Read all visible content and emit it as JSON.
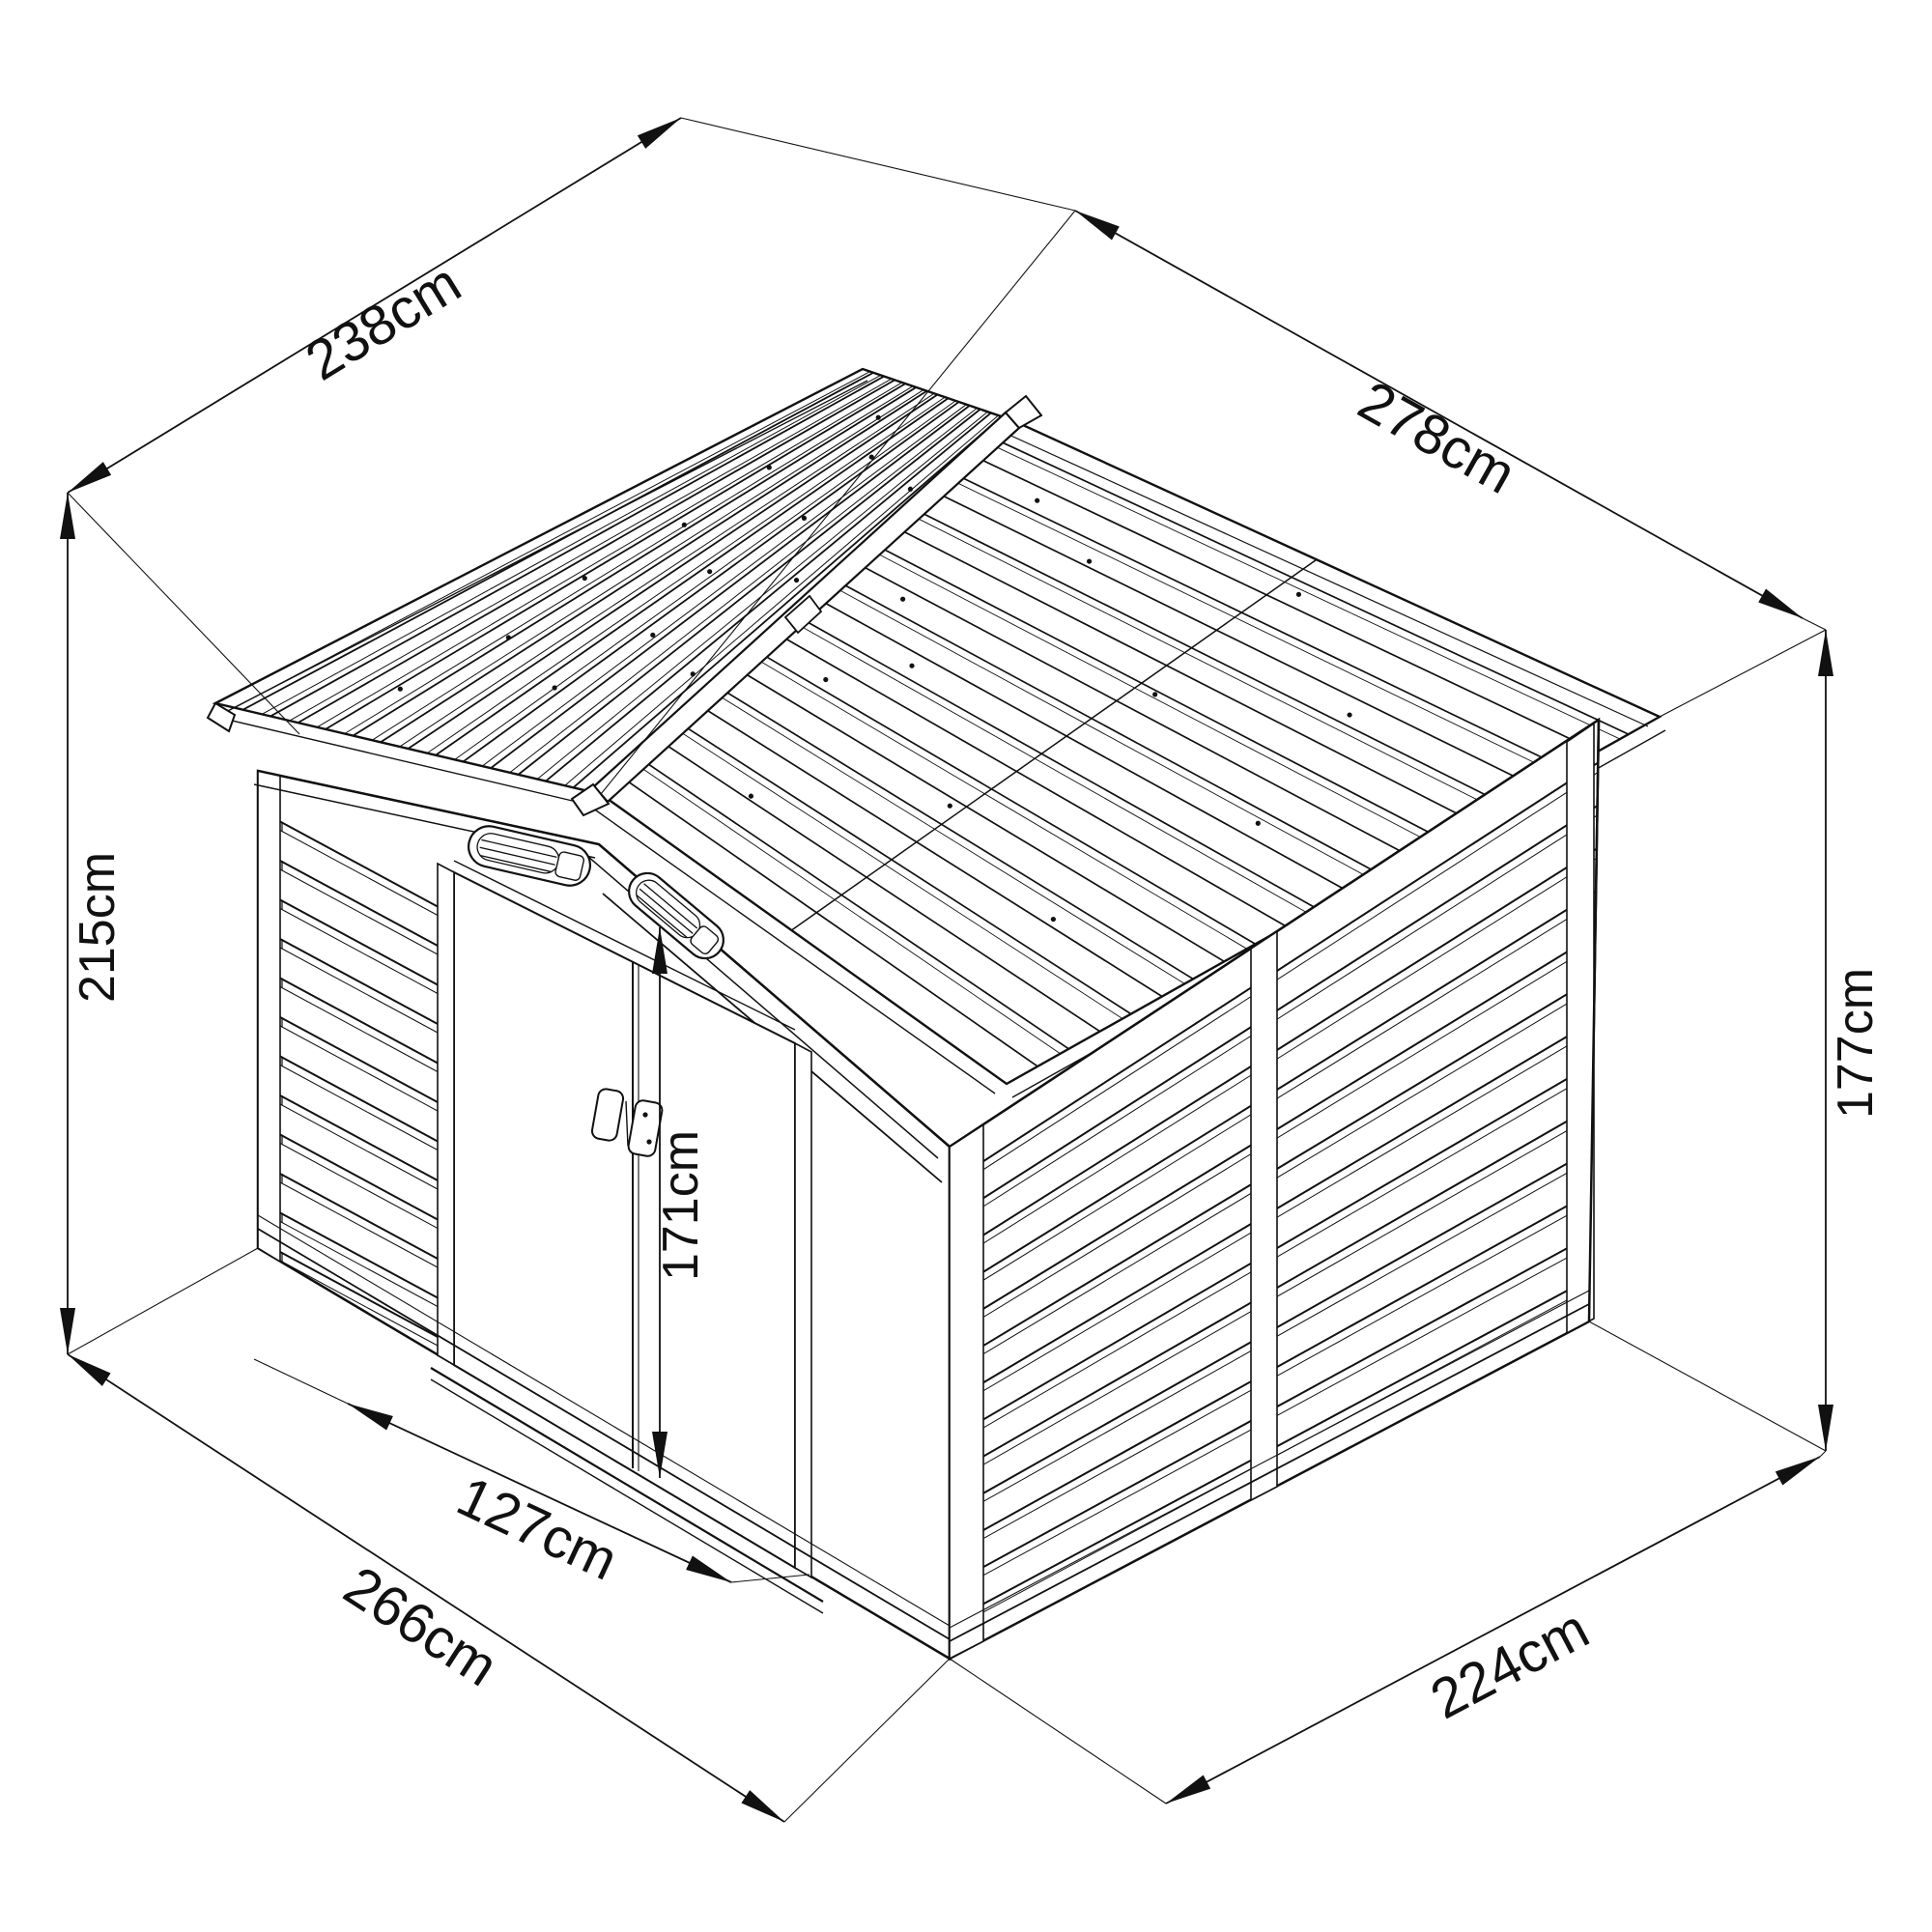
{
  "diagram": {
    "kind": "isometric-dimension-drawing",
    "subject": "metal garden shed with gable roof and double sliding doors",
    "unit": "cm",
    "background_color": "#ffffff",
    "line_color": "#111111",
    "dimensions": {
      "roof_depth": {
        "label": "238cm",
        "value": 238
      },
      "roof_width": {
        "label": "278cm",
        "value": 278
      },
      "total_height": {
        "label": "215cm",
        "value": 215
      },
      "wall_height": {
        "label": "177cm",
        "value": 177
      },
      "door_height": {
        "label": "171cm",
        "value": 171
      },
      "door_opening_width": {
        "label": "127cm",
        "value": 127
      },
      "base_depth": {
        "label": "266cm",
        "value": 266
      },
      "base_width": {
        "label": "224cm",
        "value": 224
      }
    }
  }
}
